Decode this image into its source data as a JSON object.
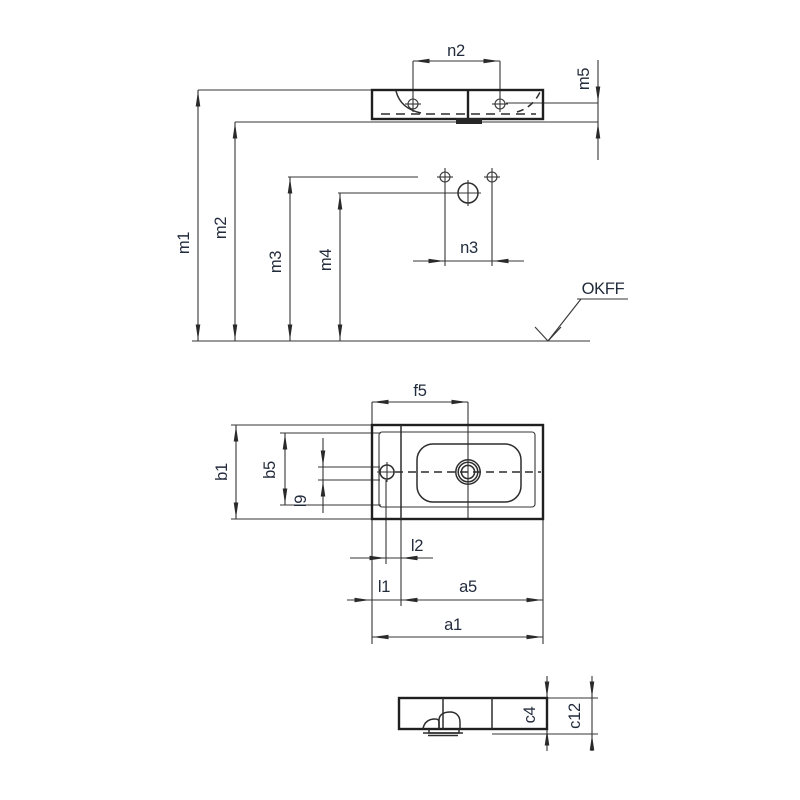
{
  "page": {
    "background": "#ffffff",
    "line_color": "#2a2a2a",
    "label_color": "#232c3d"
  },
  "front_view": {
    "n2": "n2",
    "m5": "m5",
    "m1": "m1",
    "m2": "m2",
    "m3": "m3",
    "m4": "m4",
    "n3": "n3",
    "okff_label": "OKFF"
  },
  "plan_view": {
    "f5": "f5",
    "b1": "b1",
    "b5": "b5",
    "l9": "l9",
    "l2": "l2",
    "l1": "l1",
    "a5": "a5",
    "a1": "a1"
  },
  "side_view": {
    "c4": "c4",
    "c12": "c12"
  }
}
